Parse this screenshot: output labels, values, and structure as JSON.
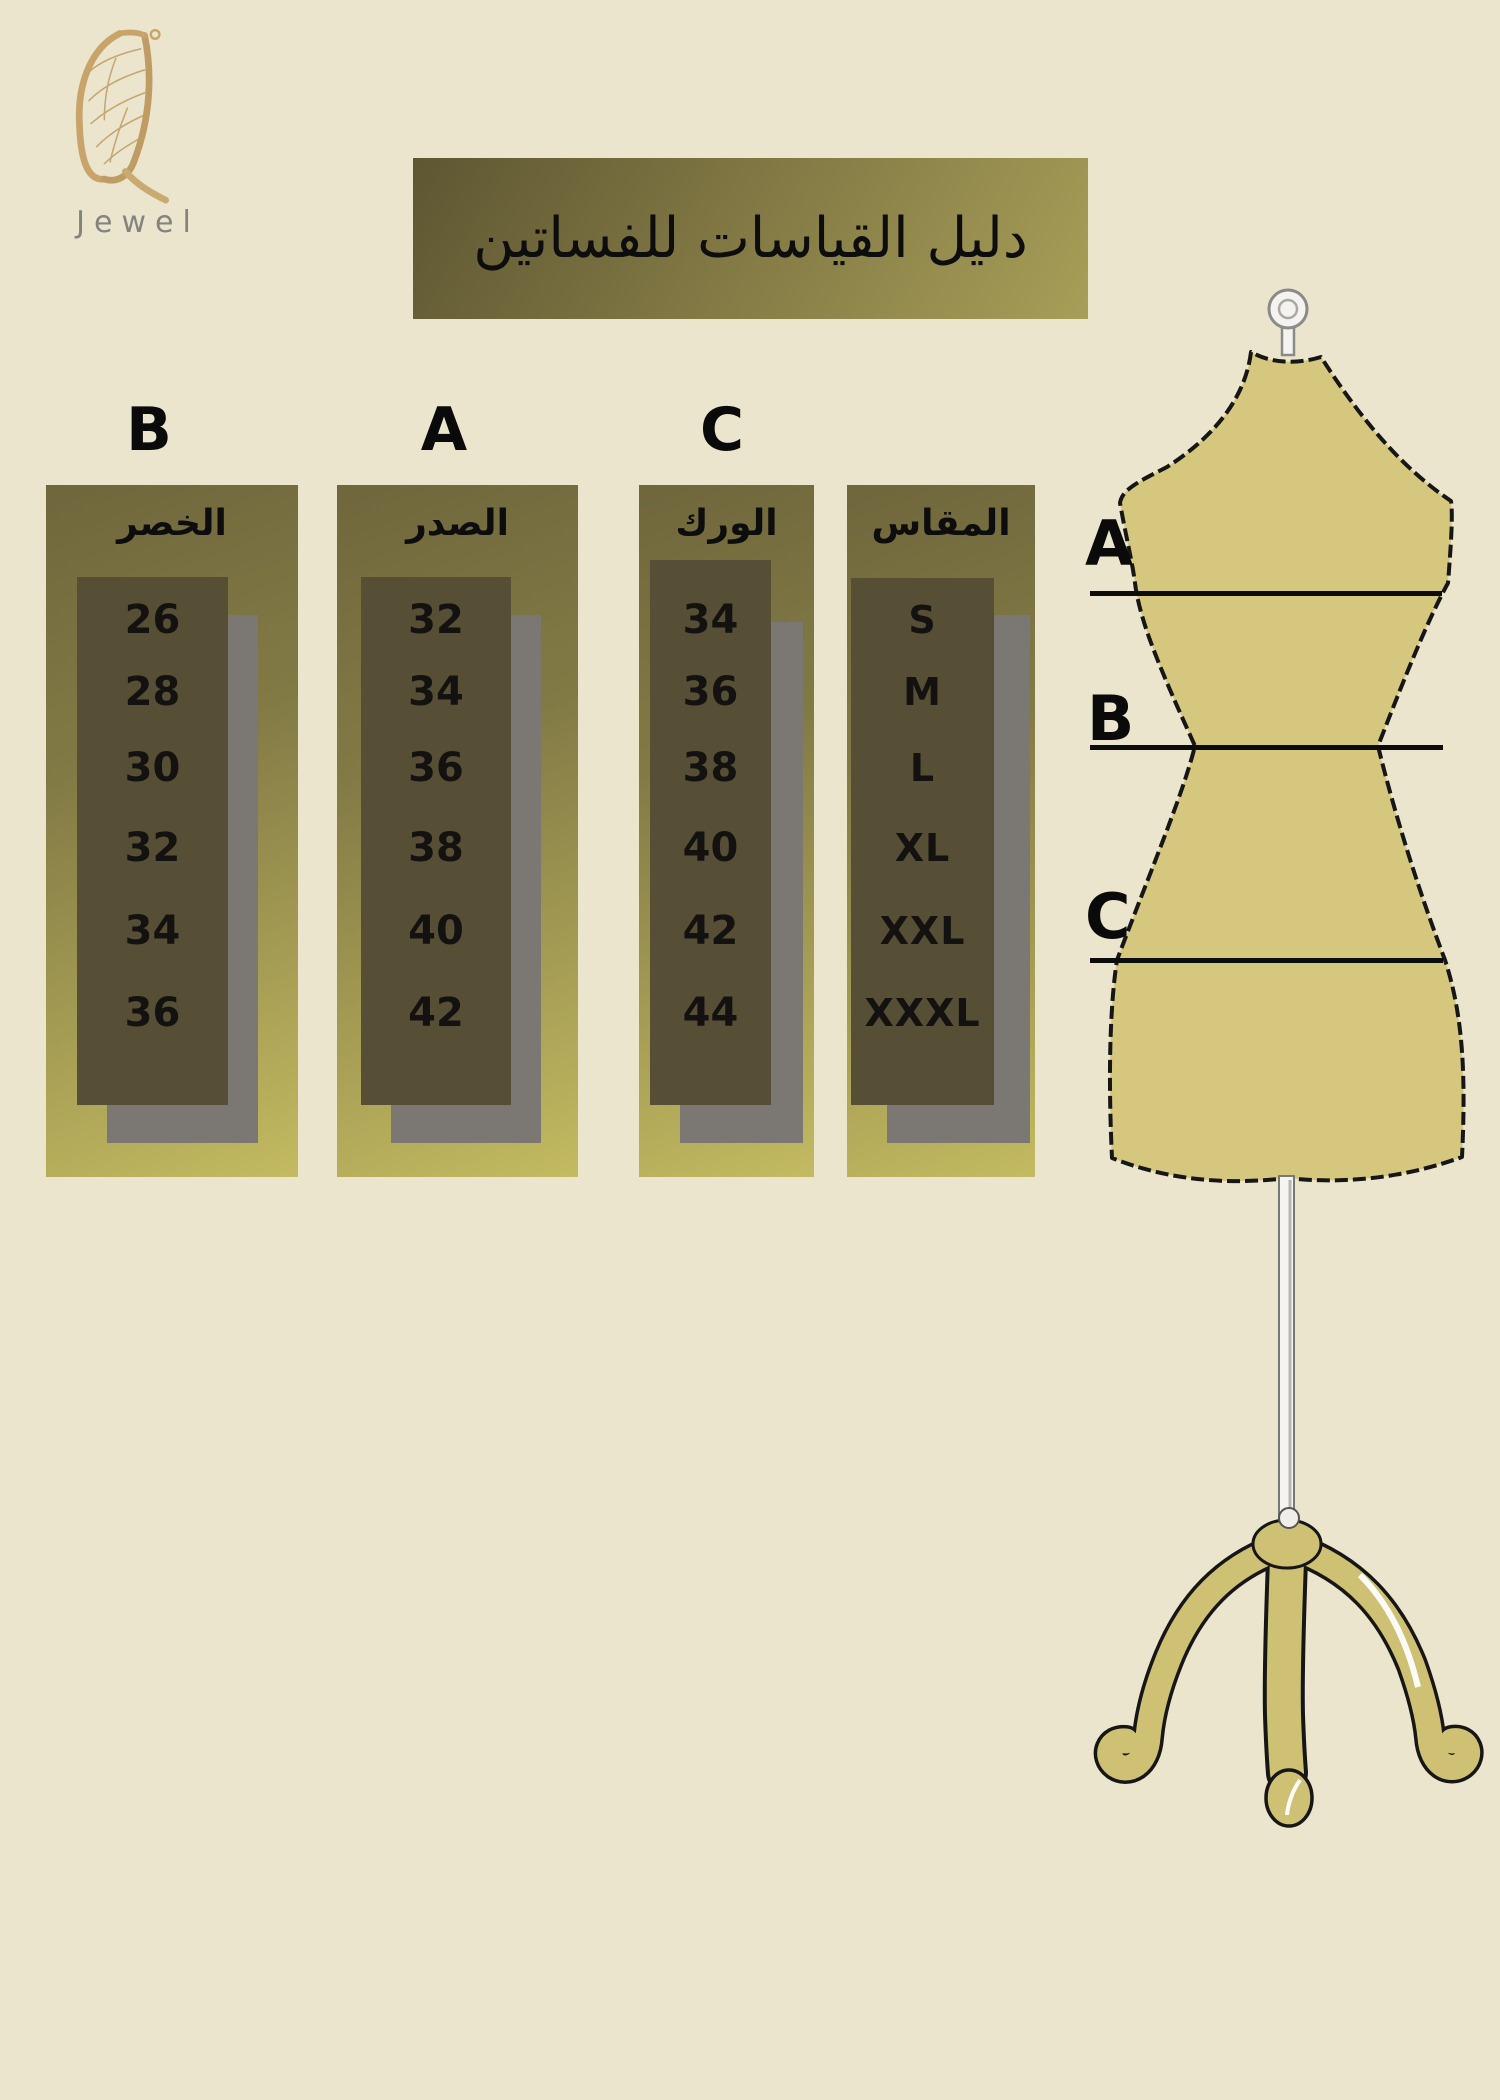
{
  "brand": {
    "name": "Jewel"
  },
  "title": "دليل القياسات للفساتين",
  "columns": [
    {
      "letter": "B",
      "header": "الخصر",
      "values": [
        "26",
        "28",
        "30",
        "32",
        "34",
        "36"
      ]
    },
    {
      "letter": "A",
      "header": "الصدر",
      "values": [
        "32",
        "34",
        "36",
        "38",
        "40",
        "42"
      ]
    },
    {
      "letter": "C",
      "header": "الورك",
      "values": [
        "34",
        "36",
        "38",
        "40",
        "42",
        "44"
      ]
    },
    {
      "letter": "",
      "header": "المقاس",
      "values": [
        "S",
        "M",
        "L",
        "XL",
        "XXL",
        "XXXL"
      ]
    }
  ],
  "mannequin": {
    "labels": [
      {
        "letter": "A"
      },
      {
        "letter": "B"
      },
      {
        "letter": "C"
      }
    ]
  },
  "colors": {
    "background": "#eae5cc",
    "banner_dark": "#5e5632",
    "banner_light": "#a79e58",
    "panel_top": "#6f673c",
    "panel_bottom": "#c3ba61",
    "inner_rect": "#564f36",
    "shadow_gray": "#7b7873",
    "mannequin_body": "#d6c77e",
    "logo_gold": "#c9a46a",
    "brand_gray": "#84847e",
    "text": "#111111"
  }
}
